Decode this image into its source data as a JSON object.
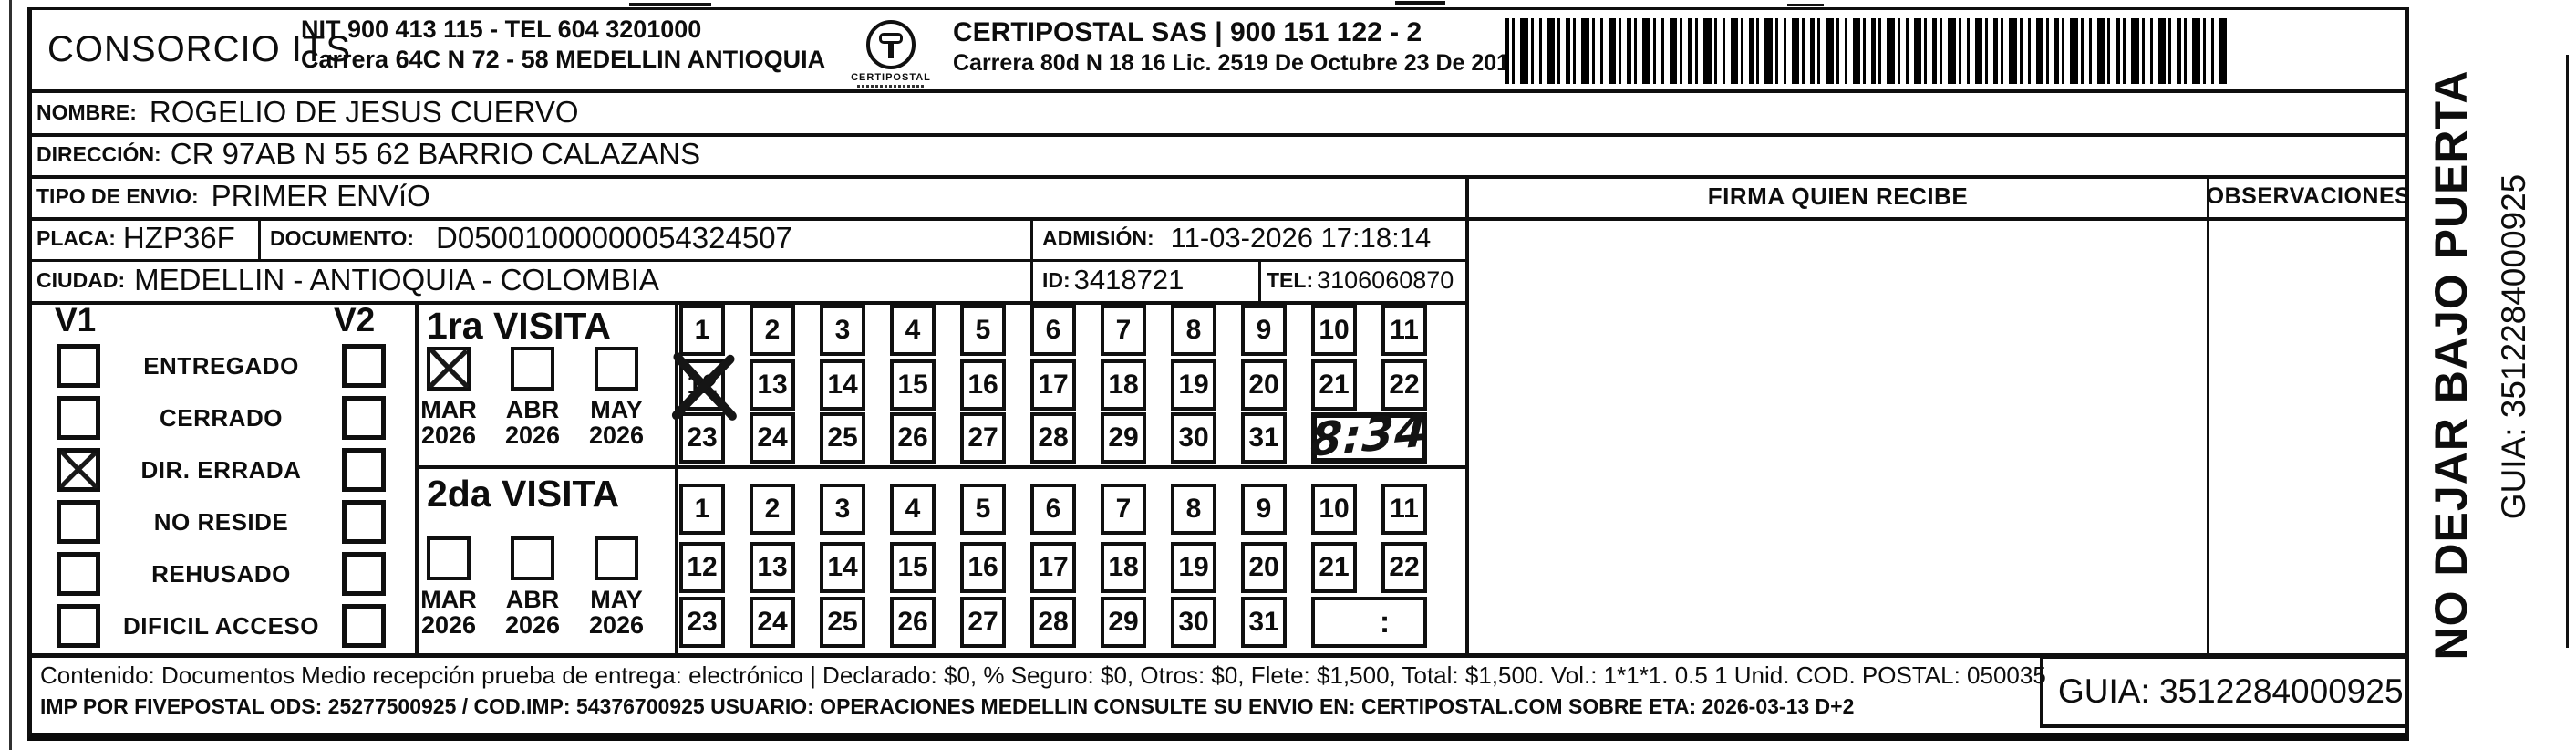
{
  "header": {
    "consorcio_name": "CONSORCIO ITS",
    "consorcio_info1": "NIT 900 413 115 - TEL 604 3201000",
    "consorcio_info2": "Carrera 64C N 72 - 58 MEDELLIN ANTIOQUIA",
    "logo_caption": "CERTIPOSTAL",
    "certipostal_info1": "CERTIPOSTAL SAS | 900 151 122 - 2",
    "certipostal_info2": "Carrera 80d N 18 16  Lic. 2519 De Octubre 23 De 2015"
  },
  "shipment": {
    "nombre_label": "NOMBRE:",
    "nombre_value": "ROGELIO DE JESUS CUERVO",
    "direccion_label": "DIRECCIÓN:",
    "direccion_value": "CR 97AB N 55 62 BARRIO CALAZANS",
    "tipo_envio_label": "TIPO DE ENVIO:",
    "tipo_envio_value": "PRIMER ENVíO",
    "placa_label": "PLACA:",
    "placa_value": "HZP36F",
    "documento_label": "DOCUMENTO:",
    "documento_value": "D05001000000054324507",
    "admision_label": "ADMISIÓN:",
    "admision_value": "11-03-2026 17:18:14",
    "ciudad_label": "CIUDAD:",
    "ciudad_value": "MEDELLIN - ANTIOQUIA - COLOMBIA",
    "id_label": "ID:",
    "id_value": "3418721",
    "tel_label": "TEL:",
    "tel_value": "3106060870"
  },
  "delivery": {
    "firma_header": "FIRMA QUIEN RECIBE",
    "observaciones_header": "OBSERVACIONES",
    "status_col1": "V1",
    "status_col2": "V2",
    "status_items": [
      {
        "label": "ENTREGADO",
        "v1": false,
        "v2": false
      },
      {
        "label": "CERRADO",
        "v1": false,
        "v2": false
      },
      {
        "label": "DIR. ERRADA",
        "v1": true,
        "v2": false
      },
      {
        "label": "NO RESIDE",
        "v1": false,
        "v2": false
      },
      {
        "label": "REHUSADO",
        "v1": false,
        "v2": false
      },
      {
        "label": "DIFICIL ACCESO",
        "v1": false,
        "v2": false
      }
    ],
    "day_rows": [
      [
        1,
        2,
        3,
        4,
        5,
        6,
        7,
        8,
        9,
        10,
        11
      ],
      [
        12,
        13,
        14,
        15,
        16,
        17,
        18,
        19,
        20,
        21,
        22
      ],
      [
        23,
        24,
        25,
        26,
        27,
        28,
        29,
        30,
        31
      ]
    ],
    "visits": [
      {
        "title": "1ra VISITA",
        "months": [
          {
            "month": "MAR",
            "year": "2026",
            "checked": true
          },
          {
            "month": "ABR",
            "year": "2026",
            "checked": false
          },
          {
            "month": "MAY",
            "year": "2026",
            "checked": false
          }
        ],
        "crossed_days": [
          12
        ],
        "time_value": "8:34",
        "time_handwritten": true
      },
      {
        "title": "2da VISITA",
        "months": [
          {
            "month": "MAR",
            "year": "2026",
            "checked": false
          },
          {
            "month": "ABR",
            "year": "2026",
            "checked": false
          },
          {
            "month": "MAY",
            "year": "2026",
            "checked": false
          }
        ],
        "crossed_days": [],
        "time_value": ":",
        "time_handwritten": false
      }
    ]
  },
  "footer": {
    "contenido_line1": "Contenido: Documentos Medio recepción prueba de entrega: electrónico | Declarado: $0, % Seguro: $0, Otros: $0, Flete: $1,500, Total: $1,500. Vol.: 1*1*1. 0.5 1 Unid. COD. POSTAL: 050035",
    "contenido_line2": "IMP POR FIVEPOSTAL ODS: 25277500925 / COD.IMP: 54376700925 USUARIO: OPERACIONES MEDELLIN CONSULTE SU ENVIO EN: CERTIPOSTAL.COM SOBRE ETA: 2026-03-13 D+2",
    "guia_value": "GUIA: 3512284000925"
  },
  "side_strip": {
    "warning": "NO DEJAR BAJO PUERTA",
    "guia": "GUIA: 3512284000925"
  },
  "colors": {
    "ink": "#0d0d0d",
    "paper": "#ffffff"
  }
}
